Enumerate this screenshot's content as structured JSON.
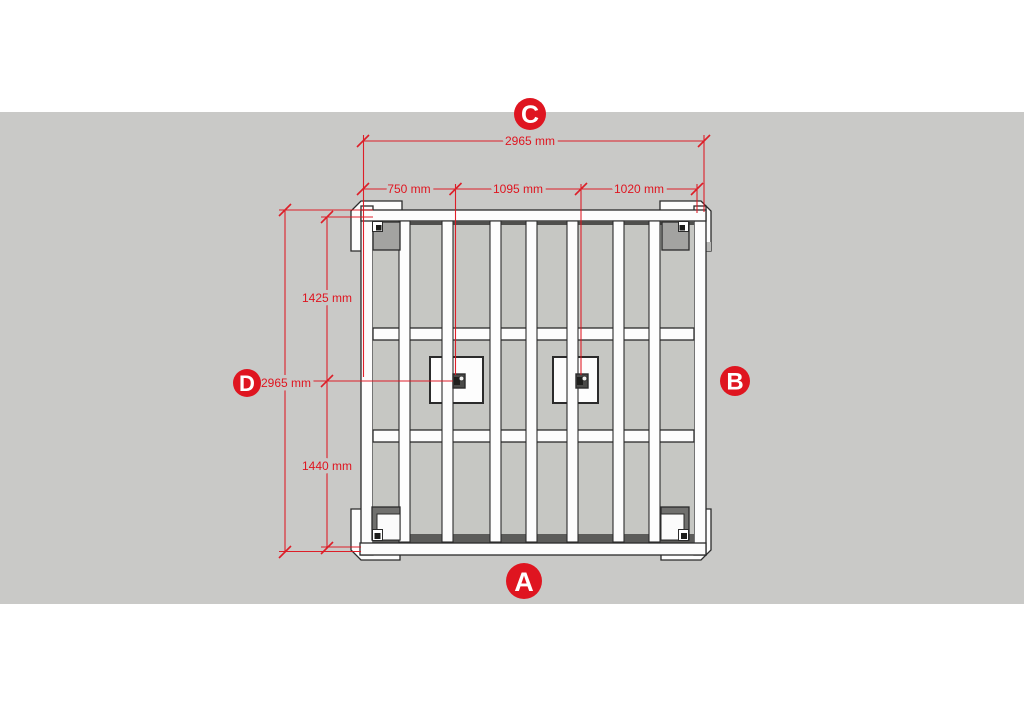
{
  "drawing": {
    "view": "top-view-frame-structure",
    "labels": {
      "top": "C",
      "bottom": "A",
      "right": "B",
      "left": "D"
    },
    "dimensions": {
      "overall_width": "2965 mm",
      "top_segments": [
        {
          "label": "750 mm"
        },
        {
          "label": "1095 mm"
        },
        {
          "label": "1020 mm"
        }
      ],
      "overall_height": "2965 mm",
      "left_segments": [
        {
          "label": "1425 mm"
        },
        {
          "label": "1440 mm"
        }
      ]
    },
    "colors": {
      "accent_red": "#df1520",
      "canvas_gray": "#c9c9c7",
      "panel_gray": "#c6c7c3",
      "outline_dark": "#2b2b2b",
      "white": "#ffffff"
    }
  }
}
